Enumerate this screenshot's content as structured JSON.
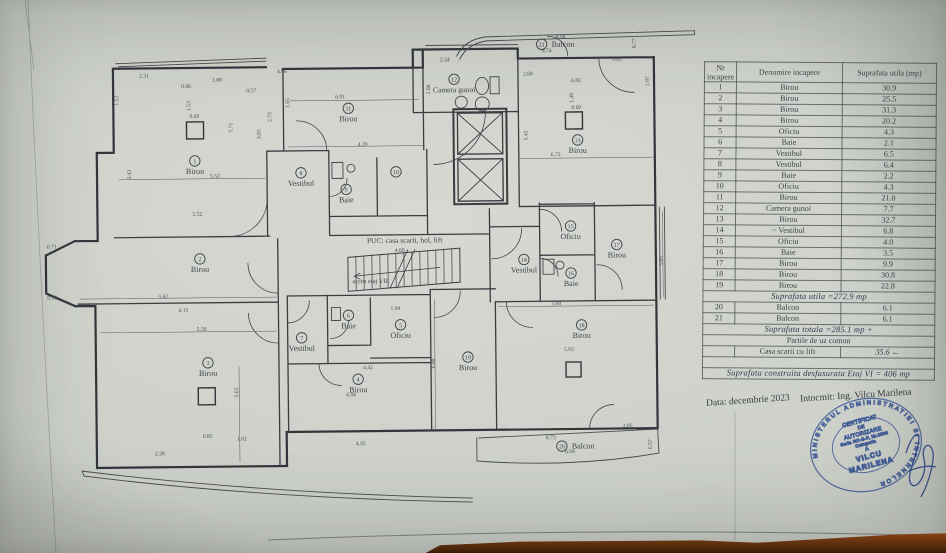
{
  "document": {
    "footer": {
      "date": "Data: decembrie 2023",
      "author": "Intocmit:  Ing. Vilcu Marilena"
    }
  },
  "plan": {
    "puc_label": "PUC: casa scarii, hol, lift",
    "access_label": "acces etaj VII",
    "rooms": [
      {
        "num": "1",
        "name": "Birou",
        "x": 196,
        "y": 159
      },
      {
        "num": "2",
        "name": "Birou",
        "x": 200,
        "y": 257
      },
      {
        "num": "3",
        "name": "Birou",
        "x": 207,
        "y": 361
      },
      {
        "num": "4",
        "name": "Birou",
        "x": 357,
        "y": 379
      },
      {
        "num": "5",
        "name": "Oficiu",
        "x": 400,
        "y": 325
      },
      {
        "num": "6",
        "name": "Baie",
        "x": 348,
        "y": 315
      },
      {
        "num": "7",
        "name": "Vestibul",
        "x": 301,
        "y": 337
      },
      {
        "num": "8",
        "name": "Vestibul",
        "x": 302,
        "y": 172
      },
      {
        "num": "9",
        "name": "Baie",
        "x": 347,
        "y": 189
      },
      {
        "num": "10",
        "name": "",
        "x": 397,
        "y": 172
      },
      {
        "num": "11",
        "name": "Birou",
        "x": 350,
        "y": 108
      },
      {
        "num": "12",
        "name": "Camera gunoi",
        "x": 456,
        "y": 80
      },
      {
        "num": "13",
        "name": "Birou",
        "x": 579,
        "y": 142
      },
      {
        "num": "14",
        "name": "Vestibul",
        "x": 524,
        "y": 261
      },
      {
        "num": "15",
        "name": "Oficiu",
        "x": 571,
        "y": 228
      },
      {
        "num": "16",
        "name": "Baie",
        "x": 571,
        "y": 275
      },
      {
        "num": "17",
        "name": "Birou",
        "x": 617,
        "y": 247
      },
      {
        "num": "18",
        "name": "Birou",
        "x": 581,
        "y": 327
      },
      {
        "num": "19",
        "name": "Birou",
        "x": 467,
        "y": 358
      },
      {
        "num": "20",
        "name": "Balcon",
        "x": 560,
        "y": 448,
        "inline": true
      },
      {
        "num": "21",
        "name": "Balcon",
        "x": 544,
        "y": 46,
        "inline": true
      }
    ],
    "dims": [
      {
        "t": "2.31",
        "x": 146,
        "y": 75
      },
      {
        "t": "4.96",
        "x": 284,
        "y": 72
      },
      {
        "t": "1.88",
        "x": 219,
        "y": 80
      },
      {
        "t": "0.86",
        "x": 188,
        "y": 86
      },
      {
        "t": "0.57",
        "x": 253,
        "y": 91
      },
      {
        "t": "2.24",
        "x": 447,
        "y": 62
      },
      {
        "t": "8.94",
        "x": 563,
        "y": 40
      },
      {
        "t": "8.74",
        "x": 549,
        "y": 54
      },
      {
        "t": "3.82",
        "x": 619,
        "y": 63
      },
      {
        "t": "2.68",
        "x": 530,
        "y": 77
      },
      {
        "t": "6.82",
        "x": 578,
        "y": 84
      },
      {
        "t": "0.60",
        "x": 196,
        "y": 116
      },
      {
        "t": "0.60",
        "x": 578,
        "y": 111
      },
      {
        "t": "6.01",
        "x": 342,
        "y": 98
      },
      {
        "t": "4.29",
        "x": 364,
        "y": 146
      },
      {
        "t": "5.52",
        "x": 216,
        "y": 176
      },
      {
        "t": "5.52",
        "x": 198,
        "y": 214
      },
      {
        "t": "5.62",
        "x": 163,
        "y": 296
      },
      {
        "t": "4.15",
        "x": 183,
        "y": 310
      },
      {
        "t": "5.58",
        "x": 201,
        "y": 329
      },
      {
        "t": "0.71",
        "x": 52,
        "y": 245
      },
      {
        "t": "0.90",
        "x": 52,
        "y": 296
      },
      {
        "t": "4.60",
        "x": 400,
        "y": 252
      },
      {
        "t": "1.94",
        "x": 395,
        "y": 310
      },
      {
        "t": "4.42",
        "x": 367,
        "y": 369
      },
      {
        "t": "6.06",
        "x": 350,
        "y": 396
      },
      {
        "t": "4.95",
        "x": 359,
        "y": 445
      },
      {
        "t": "3.00",
        "x": 556,
        "y": 307
      },
      {
        "t": "5.93",
        "x": 568,
        "y": 353
      },
      {
        "t": "8.73",
        "x": 549,
        "y": 441
      },
      {
        "t": "6.94",
        "x": 568,
        "y": 455
      },
      {
        "t": "2.85",
        "x": 626,
        "y": 430
      },
      {
        "t": "2.28",
        "x": 158,
        "y": 453
      },
      {
        "t": "1.82",
        "x": 240,
        "y": 439
      },
      {
        "t": "0.85",
        "x": 206,
        "y": 436
      },
      {
        "t": "6.72",
        "x": 557,
        "y": 158
      },
      {
        "t": "1.52",
        "x": 120,
        "y": 98,
        "v": 1
      },
      {
        "t": "1.53",
        "x": 192,
        "y": 104,
        "v": 1
      },
      {
        "t": "5.71",
        "x": 234,
        "y": 126,
        "v": 1
      },
      {
        "t": "2.73",
        "x": 273,
        "y": 116,
        "v": 1
      },
      {
        "t": "3.85",
        "x": 262,
        "y": 133,
        "v": 1
      },
      {
        "t": "3.43",
        "x": 132,
        "y": 172,
        "v": 1
      },
      {
        "t": "1.65",
        "x": 291,
        "y": 102,
        "v": 1
      },
      {
        "t": "0.77",
        "x": 638,
        "y": 46,
        "v": 1
      },
      {
        "t": "1.97",
        "x": 651,
        "y": 84,
        "v": 1
      },
      {
        "t": "1.49",
        "x": 575,
        "y": 100,
        "v": 1
      },
      {
        "t": "5.45",
        "x": 529,
        "y": 137,
        "v": 1
      },
      {
        "t": "5.65",
        "x": 237,
        "y": 391,
        "v": 1
      },
      {
        "t": "6.00",
        "x": 434,
        "y": 364,
        "v": 1
      },
      {
        "t": "5.65",
        "x": 663,
        "y": 264,
        "v": 1
      },
      {
        "t": "2.08",
        "x": 432,
        "y": 90,
        "v": 1
      },
      {
        "t": "6.57",
        "x": 650,
        "y": 447,
        "v": 1
      }
    ]
  },
  "table": {
    "headers": [
      "Nr incapere",
      "Denumire incapere",
      "Suprafata utila (mp)"
    ],
    "rows": [
      {
        "type": "data",
        "nr": "1",
        "name": "Birou",
        "area": "30.9"
      },
      {
        "type": "data",
        "nr": "2",
        "name": "Birou",
        "area": "25.5"
      },
      {
        "type": "data",
        "nr": "3",
        "name": "Birou",
        "area": "31.3"
      },
      {
        "type": "data",
        "nr": "4",
        "name": "Birou",
        "area": "20.2"
      },
      {
        "type": "data",
        "nr": "5",
        "name": "Oficiu",
        "area": "4.3"
      },
      {
        "type": "data",
        "nr": "6",
        "name": "Baie",
        "area": "2.1"
      },
      {
        "type": "data",
        "nr": "7",
        "name": "Vestibul",
        "area": "6.5"
      },
      {
        "type": "data",
        "nr": "8",
        "name": "Vestibul",
        "area": "6.4"
      },
      {
        "type": "data",
        "nr": "9",
        "name": "Baie",
        "area": "2.2"
      },
      {
        "type": "data",
        "nr": "10",
        "name": "Oficiu",
        "area": "4.3"
      },
      {
        "type": "data",
        "nr": "11",
        "name": "Birou",
        "area": "21.0"
      },
      {
        "type": "data",
        "nr": "12",
        "name": "Camera gunoi",
        "area": "7.7"
      },
      {
        "type": "data",
        "nr": "13",
        "name": "Birou",
        "area": "32.7"
      },
      {
        "type": "data",
        "nr": "14",
        "name": "Vestibul",
        "area": "6.8",
        "mark": "~"
      },
      {
        "type": "data",
        "nr": "15",
        "name": "Oficiu",
        "area": "4.0"
      },
      {
        "type": "data",
        "nr": "16",
        "name": "Baie",
        "area": "3.5"
      },
      {
        "type": "data",
        "nr": "17",
        "name": "Birou",
        "area": "9.9"
      },
      {
        "type": "data",
        "nr": "18",
        "name": "Birou",
        "area": "30.8"
      },
      {
        "type": "data",
        "nr": "19",
        "name": "Birou",
        "area": "22.8"
      },
      {
        "type": "note_hand",
        "text": "Suprafata utila =272.9 mp"
      },
      {
        "type": "data",
        "nr": "20",
        "name": "Balcon",
        "area": "6.1"
      },
      {
        "type": "data",
        "nr": "21",
        "name": "Balcon",
        "area": "6.1"
      },
      {
        "type": "note_hand",
        "text": "Suprafata totala =285.1 mp +"
      },
      {
        "type": "note_plain",
        "text": "Partile de uz comun"
      },
      {
        "type": "data",
        "nr": "",
        "name": "Casa scarii cu lift",
        "area": "35.6 ←",
        "hand_area": true
      },
      {
        "type": "empty"
      },
      {
        "type": "note_hand",
        "text": "Suprafata construita desfasurata Etaj VI = 406 mp"
      }
    ]
  },
  "stamp": {
    "ring_text": "MINISTERUL ADMINISTRATIEI SI INTERNELOR",
    "lines": [
      "CERTIFICAT",
      "DE",
      "AUTORIZARE",
      "Seria RO-B-F, Nr.0506",
      "Categoria",
      "A",
      "VILCU",
      "MARILENA"
    ]
  },
  "colors": {
    "stamp_blue": "#2d53b5",
    "ink": "#3a3e46",
    "wall": "#33353b"
  }
}
